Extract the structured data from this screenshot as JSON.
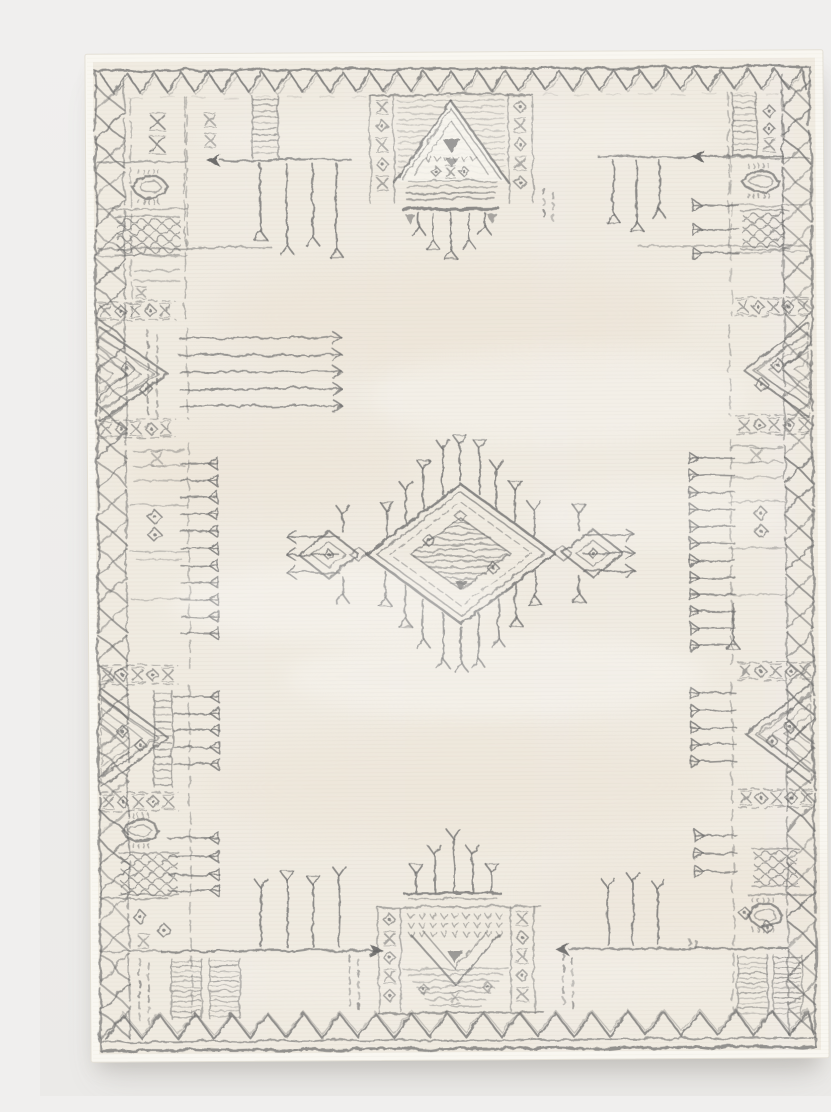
{
  "image": {
    "type": "product-photograph",
    "alt_text": "Ivory distressed Moroccan-style area rug with charcoal tribal motifs: zigzag borders, glyph panels along the sides, fringe tassel combs, and a central diamond medallion with radiating tassels",
    "background": "seamless light studio backdrop",
    "orientation": "portrait"
  },
  "palette": {
    "page_background": "#f0efee",
    "page_background_bottom": "#ebeae8",
    "rug_field": "#f0ebe1",
    "rug_field_light": "#f7f4ed",
    "rug_field_warm": "#e9ddcc",
    "rug_selvedge": "#f9f7f1",
    "rug_edge_line": "#e4e0d6",
    "motif_ink": "#6b6b6b",
    "motif_ink_dark": "#565656",
    "shadow": "#6b655c"
  },
  "motifs": {
    "border_top": "single zigzag band under a rule line",
    "border_bottom": "double zigzag band above two rule lines",
    "border_left": "lattice X-chain rail with stacked glyph panels",
    "border_right": "lattice X-chain rail with stacked glyph panels",
    "corner_panels": "boxes with X glyphs, sun blobs, dotted squares, hatched triangles with diamond eyes, XOXO bands",
    "side_combs": "horizontal fringe lines tipped with goblet cups and open arrows",
    "spears": "long horizontal rods with solid arrowheads and hanging or standing tassels",
    "top_center": "framed stepped triangle with tassel shelf hanging below",
    "bottom_center": "candelabra tassels over a framed chevron shield",
    "center": "double-outlined diamond medallion with scribed core, diamond eyes, side lozenges and radiating goblet tassels"
  }
}
